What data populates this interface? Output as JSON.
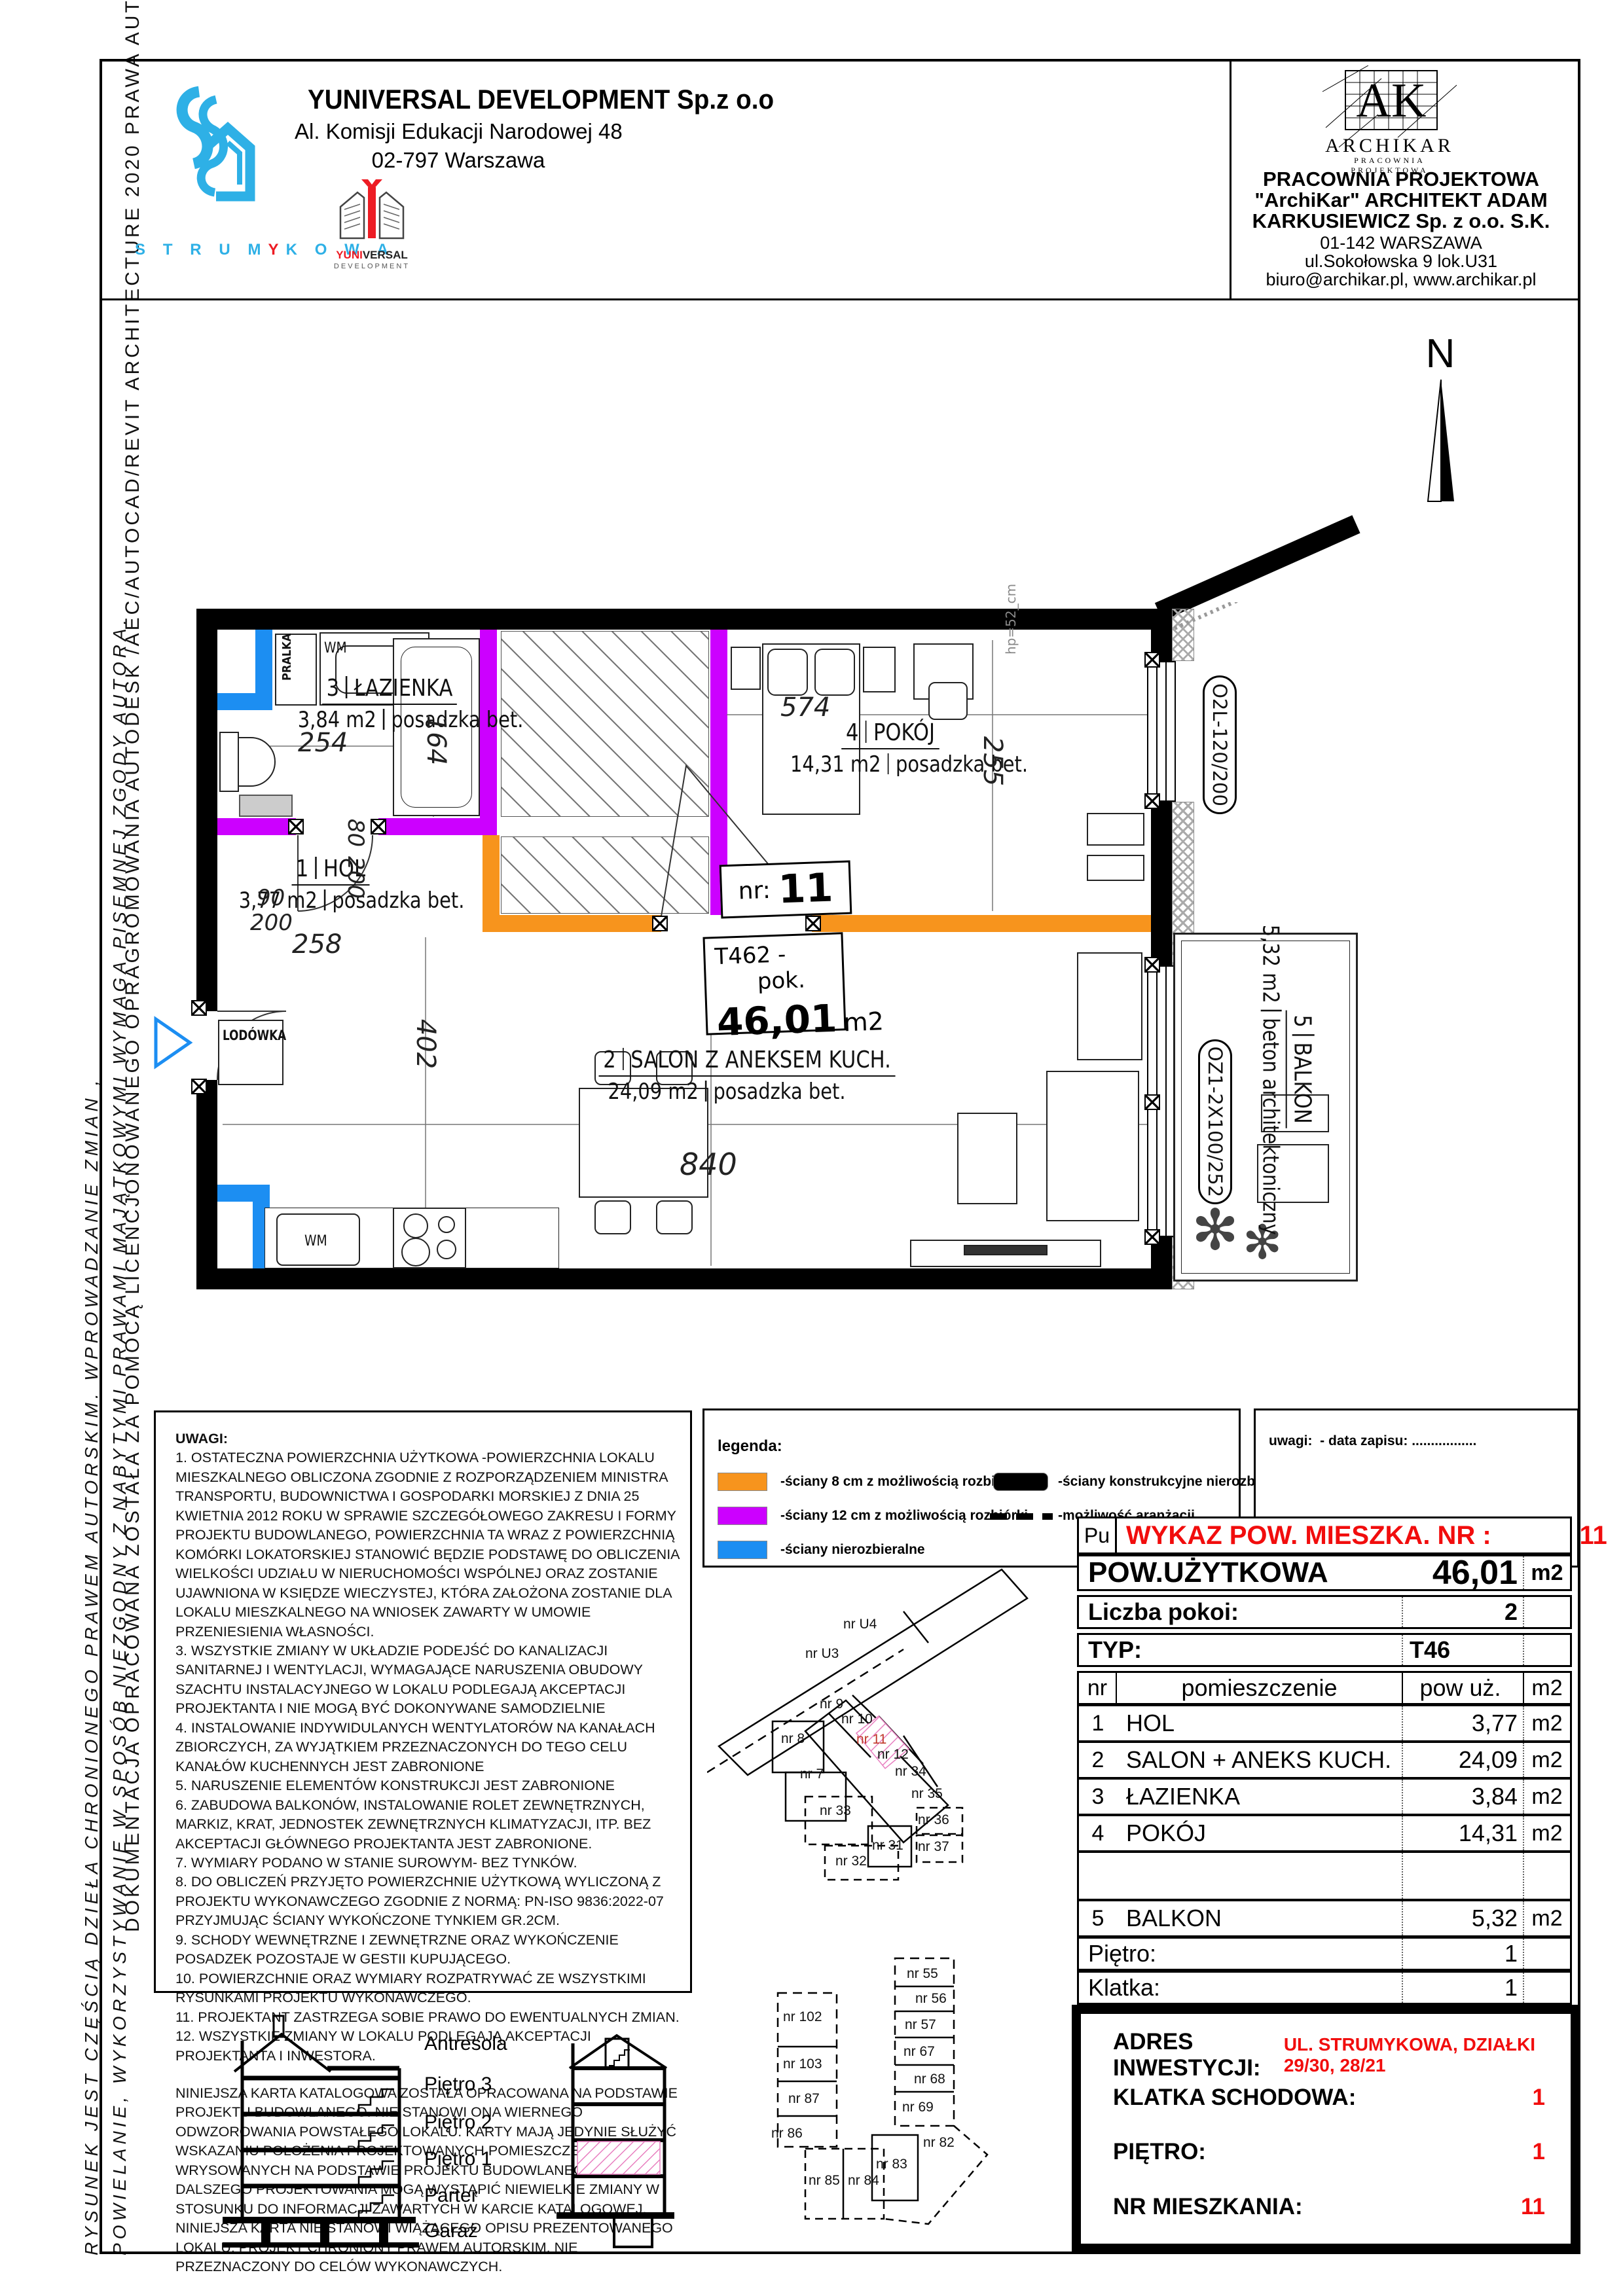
{
  "side": {
    "line1": "DOKUMENTACJA OPRACOWANA ZOSTAŁA ZA POMOCĄ LICENCJONOWANEGO OPRAGROMOWANIA AUTODESK /AEC/AUTOCAD/REVIT ARCHITECTURE 2020 PRAWA AUTORSKIE ZASTRZEŻONE",
    "line2": "RYSUNEK JEST CZĘŚCIĄ DZIEŁA CHRONIONEGO PRAWEM AUTORSKIM. WPROWADZANIE ZMIAN ,",
    "line3": "POWIELANIE, WYKORZYSTYWANIE W SPOSÓB NIEZGODNY Z NABYTYMI PRAWAMI MAJĄTKOWYMI WYMAGA PISEMNEJ ZGODY AUTORA."
  },
  "header": {
    "developer": {
      "name": "YUNIVERSAL DEVELOPMENT Sp.z o.o",
      "addr1": "Al. Komisji Edukacji Narodowej 48",
      "addr2": "02-797 Warszawa",
      "brand": "STRUMYKOWA",
      "logo_top": "YUNIVERSAL",
      "logo_bottom": "DEVELOPMENT"
    },
    "studio": {
      "logo_main": "ARCHIKAR",
      "logo_sub": "PRACOWNIA PROJEKTOWA",
      "line1": "PRACOWNIA PROJEKTOWA",
      "line2": "\"ArchiKar\" ARCHITEKT ADAM",
      "line3": "KARKUSIEWICZ Sp. z o.o. S.K.",
      "addr1": "01-142 WARSZAWA",
      "addr2": "ul.Sokołowska 9 lok.U31",
      "addr3": "biuro@archikar.pl, www.archikar.pl"
    },
    "north": "N"
  },
  "plan": {
    "unit_label": "nr:",
    "unit_value": "11",
    "type_code": "T46",
    "type_rooms": "2 -pok.",
    "type_area": "46,01",
    "type_unit": "m2",
    "rooms": [
      {
        "num": "3",
        "name": "ŁAZIENKA",
        "area": "3,84 m2",
        "floor": "posadzka bet."
      },
      {
        "num": "1",
        "name": "HOL",
        "area": "3,77 m2",
        "floor": "posadzka bet."
      },
      {
        "num": "4",
        "name": "POKÓJ",
        "area": "14,31 m2",
        "floor": "posadzka bet."
      },
      {
        "num": "2",
        "name": "SALON Z ANEKSEM KUCH.",
        "area": "24,09 m2",
        "floor": "posadzka bet."
      },
      {
        "num": "5",
        "name": "BALKON",
        "area": "5,32 m2",
        "floor": "beton architektoniczny"
      }
    ],
    "dims": {
      "bath_w": "254",
      "bath_l": "164",
      "hol_w": "258",
      "room_w": "574",
      "room_d": "255",
      "salon_w": "840",
      "salon_d": "402",
      "door_bath": {
        "w": "80",
        "h": "200"
      },
      "door_entry": {
        "w": "90",
        "h": "200"
      },
      "sill": "hp=52_cm"
    },
    "labels": {
      "fridge": "LODÓWKA",
      "washer": "PRALKA",
      "wm": "WM",
      "window_top": "O2L-120/200",
      "window_balcony": "OZ1-2X100/252"
    }
  },
  "notes": {
    "title": "UWAGI:",
    "items": [
      "1.  OSTATECZNA POWIERZCHNIA UŻYTKOWA -POWIERZCHNIA LOKALU MIESZKALNEGO OBLICZONA ZGODNIE Z ROZPORZĄDZENIEM MINISTRA TRANSPORTU, BUDOWNICTWA I GOSPODARKI MORSKIEJ Z DNIA 25 KWIETNIA 2012 ROKU W SPRAWIE SZCZEGÓŁOWEGO ZAKRESU I FORMY PROJEKTU BUDOWLANEGO, POWIERZCHNIA TA WRAZ Z POWIERZCHNIĄ KOMÓRKI LOKATORSKIEJ STANOWIĆ BĘDZIE PODSTAWĘ DO OBLICZENIA WIELKOŚCI UDZIAŁU W NIERUCHOMOŚCI WSPÓLNEJ ORAZ ZOSTANIE UJAWNIONA W KSIĘDZE WIECZYSTEJ, KTÓRA ZAŁOŻONA ZOSTANIE DLA LOKALU MIESZKALNEGO NA WNIOSEK ZAWARTY W UMOWIE PRZENIESIENIA WŁASNOŚCI.",
      "3.    WSZYSTKIE ZMIANY W UKŁADZIE PODEJŚĆ DO KANALIZACJI SANITARNEJ I WENTYLACJI, WYMAGAJĄCE NARUSZENIA OBUDOWY SZACHTU INSTALACYJNEGO W LOKALU PODLEGAJĄ AKCEPTACJI PROJEKTANTA I NIE MOGĄ BYĆ DOKONYWANE SAMODZIELNIE",
      "4. INSTALOWANIE INDYWIDULANYCH WENTYLATORÓW NA KANAŁACH ZBIORCZYCH, ZA WYJĄTKIEM PRZEZNACZONYCH DO TEGO CELU KANAŁÓW KUCHENNYCH JEST ZABRONIONE",
      "5.  NARUSZENIE ELEMENTÓW KONSTRUKCJI JEST ZABRONIONE",
      "6. ZABUDOWA BALKONÓW, INSTALOWANIE ROLET  ZEWNĘTRZNYCH, MARKIZ, KRAT, JEDNOSTEK ZEWNĘTRZNYCH KLIMATYZACJI, ITP. BEZ AKCEPTACJI GŁÓWNEGO PROJEKTANTA JEST ZABRONIONE.",
      "7. WYMIARY PODANO W STANIE SUROWYM- BEZ TYNKÓW.",
      "8.  DO OBLICZEŃ PRZYJĘTO POWIERZCHNIE UŻYTKOWĄ WYLICZONĄ Z PROJEKTU WYKONAWCZEGO ZGODNIE Z NORMĄ: PN-ISO 9836:2022-07 PRZYJMUJĄC ŚCIANY WYKOŃCZONE TYNKIEM GR.2CM.",
      "9. SCHODY WEWNĘTRZNE I ZEWNĘTRZNE ORAZ WYKOŃCZENIE POSADZEK POZOSTAJE W GESTII KUPUJĄCEGO.",
      "10. POWIERZCHNIE ORAZ WYMIARY ROZPATRYWAĆ ZE WSZYSTKIMI RYSUNKAMI PROJEKTU WYKONAWCZEGO.",
      "11. PROJEKTANT ZASTRZEGA SOBIE PRAWO DO EWENTUALNYCH ZMIAN.",
      "12. WSZYSTKIE ZMIANY W LOKALU PODLEGAJĄ AKCEPTACJI PROJEKTANTA I INWESTORA.",
      "NINIEJSZA KARTA KATALOGOWA ZOSTAŁA OPRACOWANA NA PODSTAWIE PROJEKTU BUDOWLANEGO. NIE STANOWI ONA WIERNEGO ODWZOROWANIA POWSTAŁEGO LOKALU. KARTY MAJĄ JEDYNIE SŁUŻYĆ WSKAZANIU POŁOŻENIA PROJEKTOWANYCH POMIESZCZEŃ LOKALU  WRYSOWANYCH  NA PODSTAWIE PROJEKTU BUDOWLANEGO. W TOKU DALSZEGO PROJEKTOWANIA MOGĄ WYSTĄPIĆ NIEWIELKIE ZMIANY W STOSUNKU DO INFORMACJI  ZAWARTYCH W KARCIE KATALOGOWEJ. NINIEJSZA KARTA NIE STANOWI WIĄŻĄCEGO OPISU PREZENTOWANEGO LOKALU. PROJEKT CHRONIONY PRAWEM AUTORSKIM. NIE PRZEZNACZONY DO CELÓW WYKONAWCZYCH."
    ]
  },
  "legend": {
    "title": "legenda:",
    "items": [
      {
        "label": "-ściany 8 cm z możliwością rozbiórki"
      },
      {
        "label": "-ściany 12 cm z możliwością rozbiórki"
      },
      {
        "label": "-ściany nierozbieralne"
      },
      {
        "label": "-ściany konstrukcyjne nierozbieralne"
      },
      {
        "label": "-możliwość aranżacji"
      }
    ]
  },
  "remark": {
    "label": "uwagi:",
    "value": "- data zapisu: ................."
  },
  "keyplan": {
    "units": [
      {
        "label": "nr U4"
      },
      {
        "label": "nr U3"
      },
      {
        "label": "nr 9"
      },
      {
        "label": "nr 10"
      },
      {
        "label": "nr 11"
      },
      {
        "label": "nr 8"
      },
      {
        "label": "nr 12"
      },
      {
        "label": "nr 7"
      },
      {
        "label": "nr 34"
      },
      {
        "label": "nr 35"
      },
      {
        "label": "nr 33"
      },
      {
        "label": "nr 36"
      },
      {
        "label": "nr 31"
      },
      {
        "label": "nr 32"
      },
      {
        "label": "nr 37"
      },
      {
        "label": "nr 55"
      },
      {
        "label": "nr 56"
      },
      {
        "label": "nr 57"
      },
      {
        "label": "nr 67"
      },
      {
        "label": "nr 68"
      },
      {
        "label": "nr 69"
      },
      {
        "label": "nr 102"
      },
      {
        "label": "nr 103"
      },
      {
        "label": "nr 87"
      },
      {
        "label": "nr 86"
      },
      {
        "label": "nr 85"
      },
      {
        "label": "nr 84"
      },
      {
        "label": "nr 83"
      },
      {
        "label": "nr 82"
      }
    ]
  },
  "section": {
    "labels": [
      "Antresola",
      "Piętro 3",
      "Piętro 2",
      "Piętro 1",
      "Parter",
      "Garaż"
    ]
  },
  "table": {
    "pu": "Pu",
    "title": "WYKAZ POW. MIESZKA. NR :",
    "nr": "11",
    "area_label": "POW.UŻYTKOWA",
    "area_value": "46,01",
    "area_unit": "m2",
    "rooms_label": "Liczba pokoi:",
    "rooms_value": "2",
    "type_label": "TYP:",
    "type_value": "T46",
    "col_nr": "nr",
    "col_room": "pomieszczenie",
    "col_area": "pow uż.",
    "col_unit": "m2",
    "rows": [
      {
        "nr": "1",
        "room": "HOL",
        "area": "3,77",
        "unit": "m2"
      },
      {
        "nr": "2",
        "room": "SALON + ANEKS KUCH.",
        "area": "24,09",
        "unit": "m2"
      },
      {
        "nr": "3",
        "room": "ŁAZIENKA",
        "area": "3,84",
        "unit": "m2"
      },
      {
        "nr": "4",
        "room": "POKÓJ",
        "area": "14,31",
        "unit": "m2"
      },
      {
        "nr": "",
        "room": "",
        "area": "",
        "unit": ""
      },
      {
        "nr": "5",
        "room": "BALKON",
        "area": "5,32",
        "unit": "m2"
      }
    ],
    "floor_label": "Piętro:",
    "floor_value": "1",
    "stair_label": "Klatka:",
    "stair_value": "1"
  },
  "address": {
    "label": "ADRES INWESTYCJI:",
    "value": "UL. STRUMYKOWA, DZIAŁKI 29/30, 28/21",
    "stair_label": "KLATKA SCHODOWA:",
    "stair_value": "1",
    "floor_label": "PIĘTRO:",
    "floor_value": "1",
    "apt_label": "NR MIESZKANIA:",
    "apt_value": "11"
  },
  "colors": {
    "wall_demolish_8cm": "#F7941D",
    "wall_demolish_12cm": "#CC00FF",
    "wall_fixed": "#1C8EF2",
    "structural": "#000000",
    "highlight_red": "#F10D0D",
    "brand_blue": "#2EB0E6",
    "pink_hatch": "#E87FC0"
  }
}
